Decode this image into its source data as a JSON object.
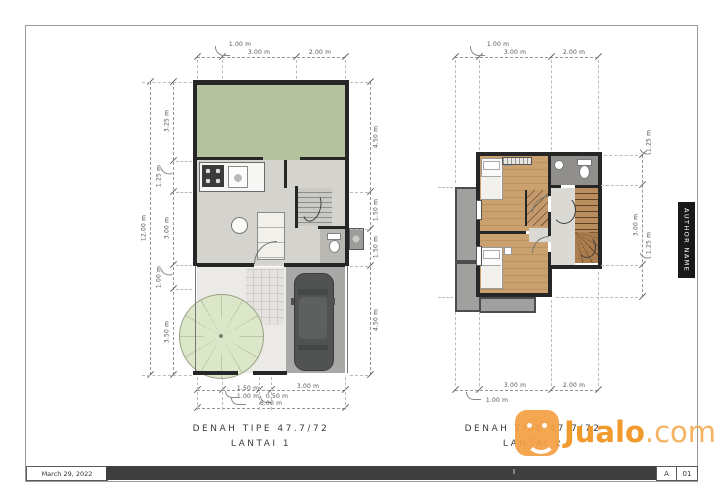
{
  "titleblock": {
    "date": "March 29, 2022",
    "author": "AUTHOR NAME",
    "center_mark": "I",
    "revision": "A",
    "sheet_no": "01"
  },
  "plan1": {
    "title1": "DENAH TIPE 47.7/72",
    "title2": "LANTAI 1",
    "dims": {
      "top": [
        "1.00 m",
        "3.00 m",
        "2.00 m"
      ],
      "left": [
        "3.25 m",
        "1.25 m",
        "3.00 m",
        "1.00 m",
        "3.50 m"
      ],
      "left_overall": "12.00 m",
      "right": [
        "4.50 m",
        "1.50 m",
        "1.50 m",
        "4.50 m"
      ],
      "bottom": [
        "1.00 m",
        "1.50 m",
        "0.50 m",
        "3.00 m"
      ],
      "bottom_overall": "6.00 m"
    }
  },
  "plan2": {
    "title1": "DENAH TIPE 47.7/72",
    "title2": "LANTAI 2",
    "dims": {
      "top": [
        "1.00 m",
        "3.00 m",
        "2.00 m"
      ],
      "right": [
        "1.25 m",
        "3.00 m",
        "1.25 m"
      ],
      "bottom": [
        "1.00 m",
        "3.00 m",
        "2.00 m"
      ]
    }
  },
  "watermark": {
    "brand": "Jualo",
    "suffix": ".com"
  },
  "colors": {
    "garden_green": "#b4c39e",
    "circle_green": "#dce6c9",
    "wood_floor": "#c49a6c",
    "wall": "#262626",
    "watermark_orange": "#f5a044"
  }
}
